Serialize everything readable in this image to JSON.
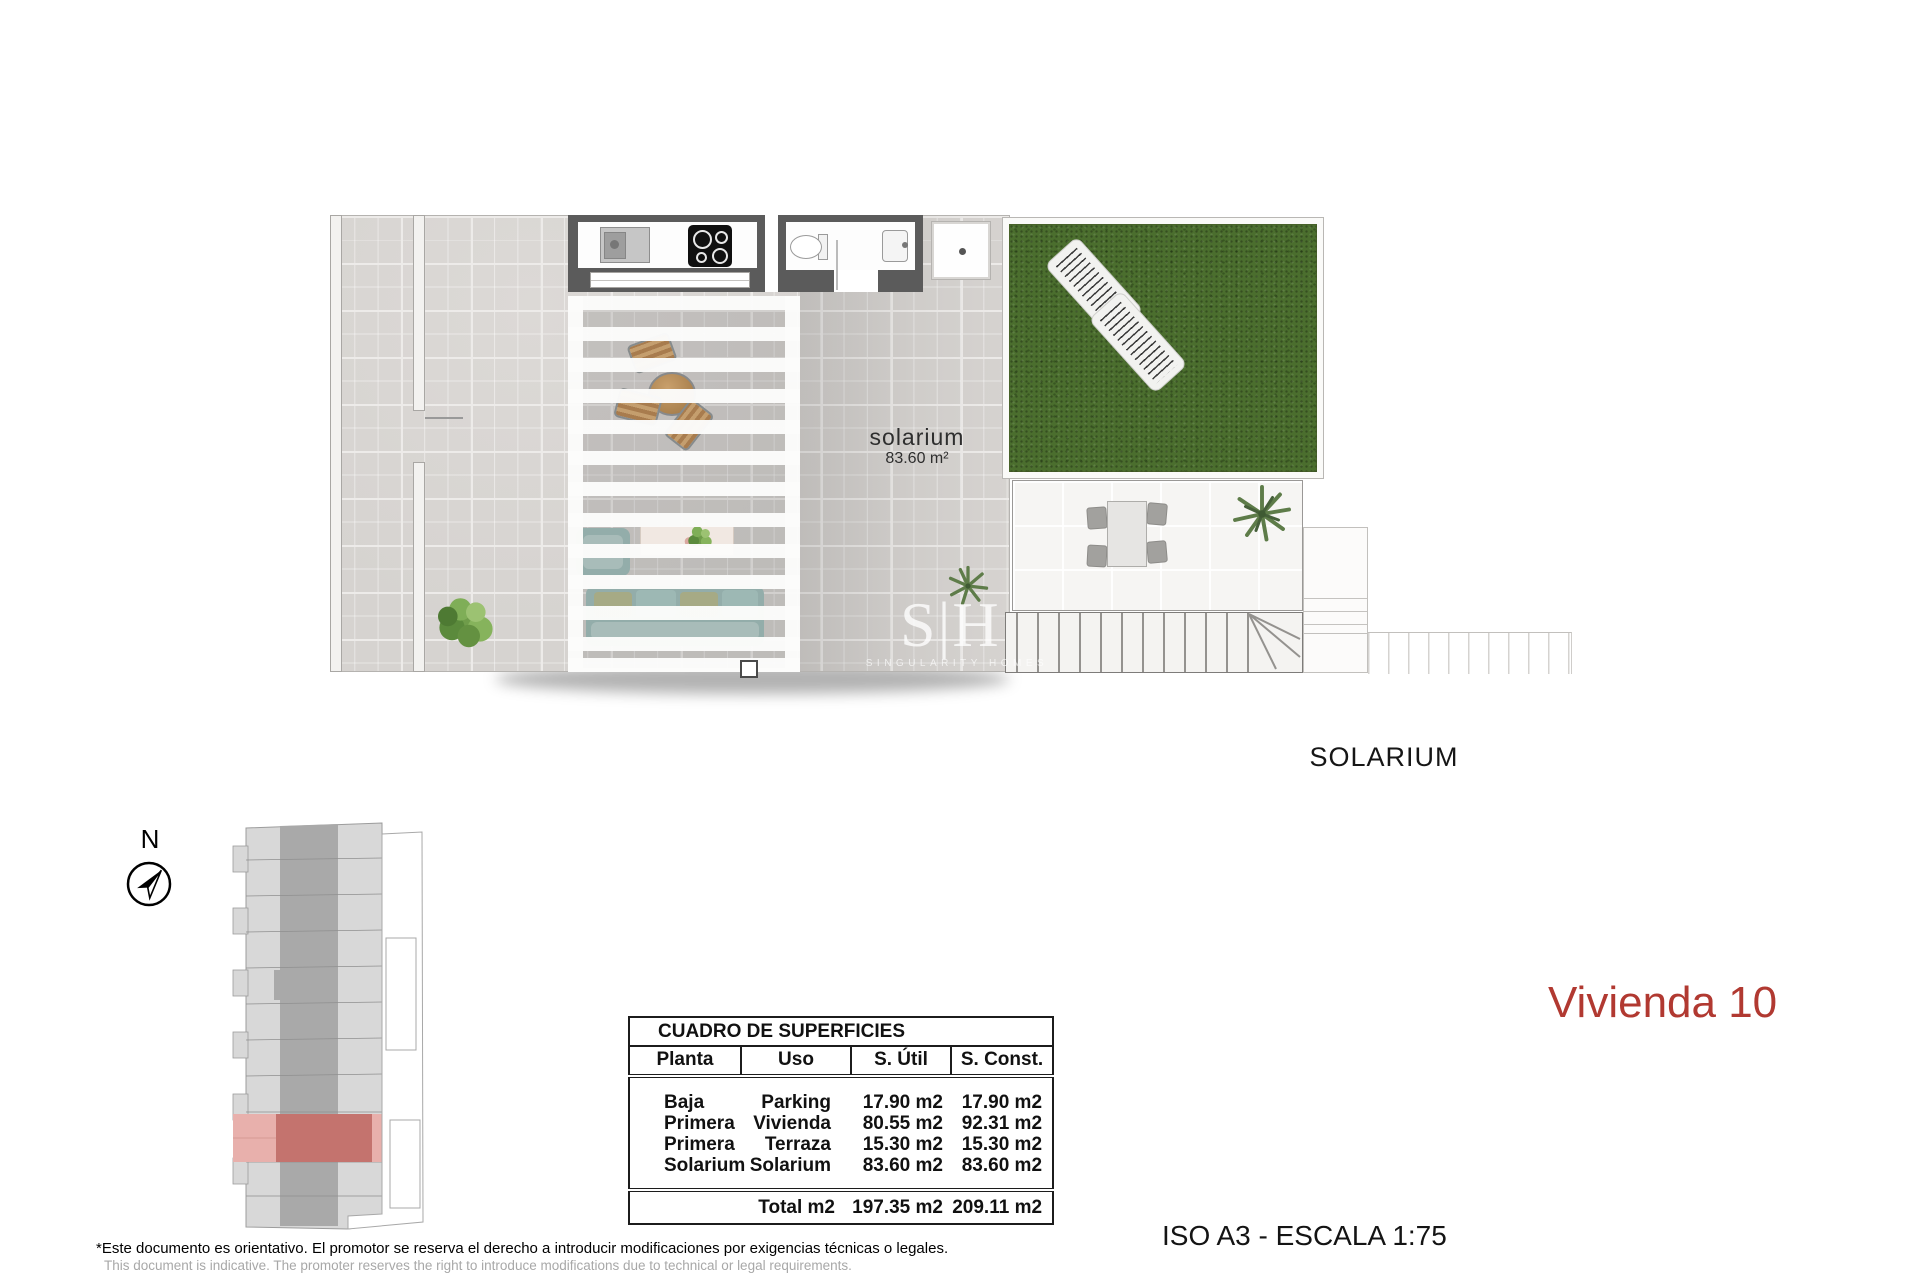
{
  "title": {
    "unit_label": "Vivienda 10",
    "color": "#b13931"
  },
  "captions": {
    "floor_name": "SOLARIUM",
    "scale_note": "ISO A3 - ESCALA 1:75"
  },
  "plan_labels": {
    "room": "solarium",
    "area": "83.60 m²"
  },
  "compass": {
    "north_label": "N"
  },
  "watermark": {
    "logo": "S|H",
    "name": "SINGULARITY HOMES"
  },
  "surfaces_table": {
    "title": "CUADRO DE SUPERFICIES",
    "columns": [
      "Planta",
      "Uso",
      "S. Útil",
      "S. Const."
    ],
    "rows": [
      {
        "planta": "Baja",
        "uso": "Parking",
        "util": "17.90 m2",
        "const": "17.90 m2"
      },
      {
        "planta": "Primera",
        "uso": "Vivienda",
        "util": "80.55 m2",
        "const": "92.31 m2"
      },
      {
        "planta": "Primera",
        "uso": "Terraza",
        "util": "15.30 m2",
        "const": "15.30 m2"
      },
      {
        "planta": "Solarium",
        "uso": "Solarium",
        "util": "83.60 m2",
        "const": "83.60 m2"
      }
    ],
    "total": {
      "label": "Total m2",
      "util": "197.35 m2",
      "const": "209.11 m2"
    }
  },
  "disclaimer": {
    "es": "*Este documento es orientativo. El promotor se reserva el derecho a introducir modificaciones por exigencias técnicas o legales.",
    "en": "This document is indicative. The promoter reserves the right to introduce modifications due to technical or legal requirements."
  },
  "colors": {
    "accent_red": "#b13931",
    "grass_green": "#4b6e2e",
    "wall_gray": "#5b5b5b",
    "highlight_pink": "#e8b0ac",
    "highlight_red": "#c4736e"
  }
}
